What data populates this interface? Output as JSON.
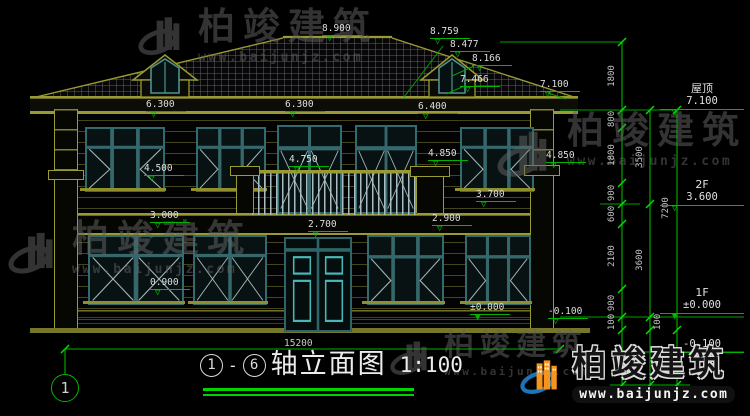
{
  "levels": [
    "8.900",
    "8.759",
    "8.477",
    "8.166",
    "7.466",
    "7.100",
    "6.300",
    "6.300",
    "6.400",
    "4.750",
    "4.850",
    "4.850",
    "4.500",
    "3.700",
    "3.000",
    "2.700",
    "2.900",
    "0.900",
    "±0.000",
    "-0.100"
  ],
  "overall_dim": "15200",
  "dims": {
    "chain_a": [
      "1800",
      "800",
      "1800",
      "900",
      "600",
      "2100",
      "900",
      "100"
    ],
    "chain_b": [
      "3500",
      "3600",
      "100"
    ],
    "chain_c": [
      "7200"
    ]
  },
  "right_margin": {
    "roof_label": "屋顶",
    "roof_value": "7.100",
    "f2_label": "2F",
    "f2_value": "3.600",
    "f1_label": "1F",
    "f1_value": "±0.000",
    "below_value": "-0.100"
  },
  "title_block": {
    "axis_from": "1",
    "dash": "-",
    "axis_to": "6",
    "name": "轴立面图",
    "scale": "1:100"
  },
  "axis_bubble": "1",
  "watermark": {
    "brand": "柏竣建筑",
    "url": "www.baijunjz.com"
  },
  "colors": {
    "cad_green": "#00b400",
    "bright_green": "#00d400",
    "olive": "#8f8f2e",
    "teal_frame": "#336a6e",
    "logo_orange": "#f7941d",
    "logo_blue": "#1b75bb"
  }
}
